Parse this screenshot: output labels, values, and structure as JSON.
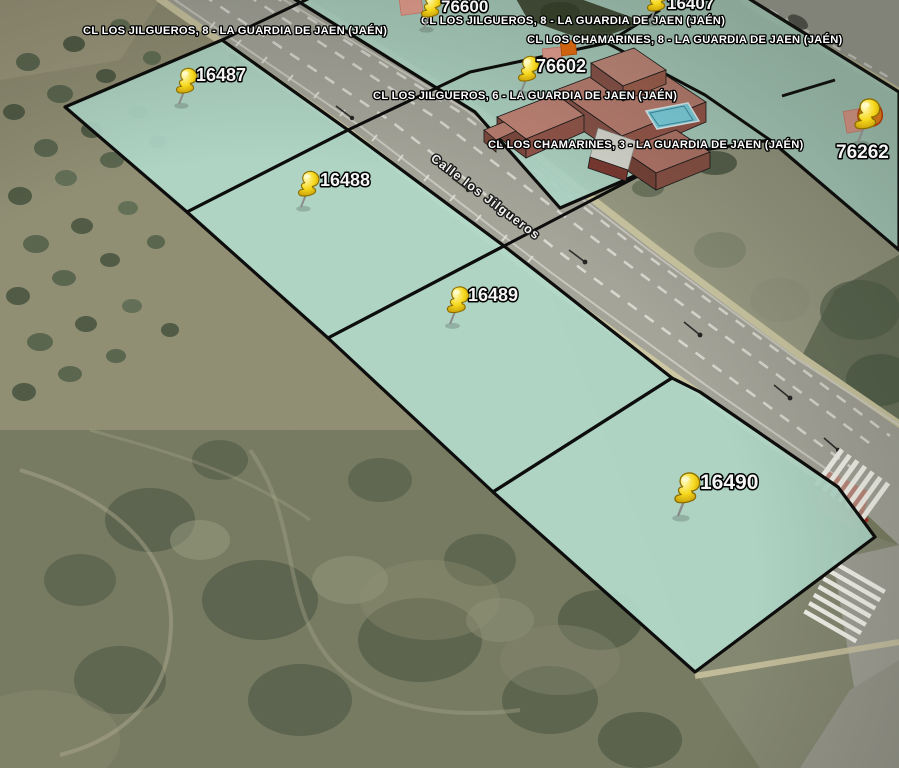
{
  "street": {
    "name": "Calle los Jilgueros"
  },
  "markers": [
    {
      "id": "76600",
      "label": "76600"
    },
    {
      "id": "16407",
      "label": "16407"
    },
    {
      "id": "16487",
      "label": "16487"
    },
    {
      "id": "76602",
      "label": "76602"
    },
    {
      "id": "76262",
      "label": "76262"
    },
    {
      "id": "16488",
      "label": "16488"
    },
    {
      "id": "16489",
      "label": "16489"
    },
    {
      "id": "16490",
      "label": "16490"
    }
  ],
  "address_labels": [
    {
      "text": "CL LOS JILGUEROS, 8 - LA GUARDIA DE JAEN (JAÉN)"
    },
    {
      "text": "CL LOS JILGUEROS, 8 - LA GUARDIA DE JAEN (JAÉN)"
    },
    {
      "text": "CL LOS CHAMARINES, 8 - LA GUARDIA DE JAEN (JAÉN)"
    },
    {
      "text": "CL LOS JILGUEROS, 6 - LA GUARDIA DE JAEN (JAÉN)"
    },
    {
      "text": "CL LOS CHAMARINES, 3 - LA GUARDIA DE JAEN (JAÉN)"
    }
  ],
  "colors": {
    "parcel_fill": "#b2d9ca",
    "parcel_border": "#0d0d0d",
    "pin_yellow": "#f6d81c",
    "road": "#a7a69b",
    "sidewalk": "#d6cfa6",
    "pool": "#82d8e8",
    "building_roof": "#bd8173"
  }
}
